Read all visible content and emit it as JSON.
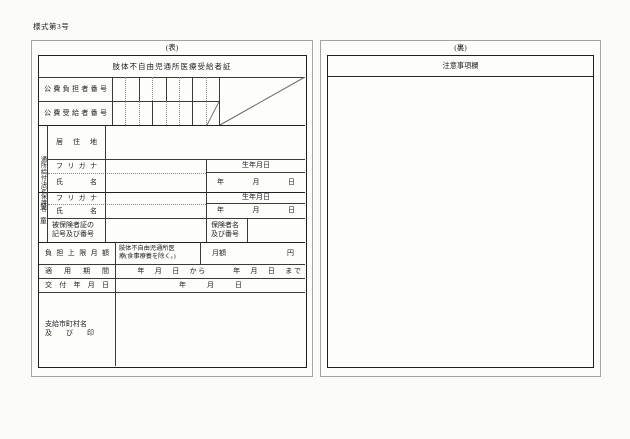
{
  "page": {
    "form_number": "様式第3号"
  },
  "front": {
    "side_label": "(表)",
    "title": "肢体不自由児通所医療受給者証",
    "payer_number_label": "公費負担者番号",
    "recipient_number_label": "公費受給者番号",
    "guardian_band_label": "通所給付決定保護者",
    "child_band_label": "児童",
    "address_label": "居住地",
    "furigana_label": "フリガナ",
    "name_label": "氏名",
    "birthdate_label": "生年月日",
    "birthdate_ymd": "年　　月　　日",
    "insured_card_label": "被保険者証の\n記号及び番号",
    "insurer_label": "保険者名\n及び番号",
    "copay_limit_label": "負担上限月額",
    "copay_limit_note": "肢体不自由児通所医\n療(食事療養を除く。)",
    "copay_monthly_label": "月額",
    "copay_unit_label": "円",
    "validity_label": "適用期間",
    "validity_value": "　　年　月　日　から　　　年　月　日　まで",
    "issue_date_label": "交付年月日",
    "issue_date_value": "年　　　月　　　日",
    "municipality_label": "支給市町村名\n及　　び　　印"
  },
  "back": {
    "side_label": "(裏)",
    "title": "注意事項欄"
  }
}
